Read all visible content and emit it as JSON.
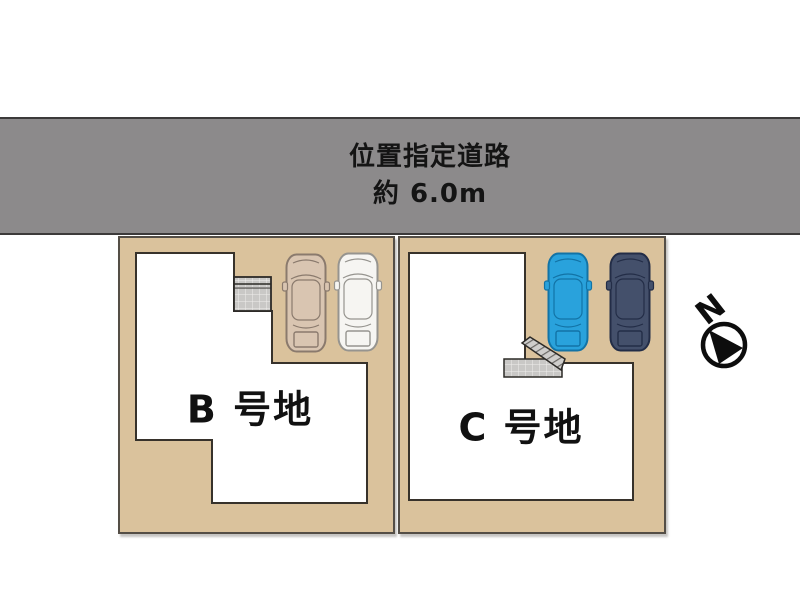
{
  "road": {
    "label_line1": "位置指定道路",
    "label_line2": "約 6.0m",
    "fill": "#8c8a8b",
    "border": "#3c3a3a"
  },
  "site": {
    "ground_color": "#dac29c",
    "lot_border": "#544e46",
    "building_fill": "#ffffff",
    "building_border": "#37322b",
    "tile_color": "#c9c8c6"
  },
  "lots": [
    {
      "id": "B",
      "label": "B 号地",
      "cars": [
        {
          "name": "beige-car",
          "color": "#d9c5b1",
          "outline": "#8a7a6d"
        },
        {
          "name": "white-car",
          "color": "#f6f5f2",
          "outline": "#96948f"
        }
      ]
    },
    {
      "id": "C",
      "label": "C 号地",
      "cars": [
        {
          "name": "blue-car",
          "color": "#29a2dc",
          "outline": "#1273a6"
        },
        {
          "name": "navy-car",
          "color": "#44506b",
          "outline": "#232d47"
        }
      ]
    }
  ],
  "compass": {
    "label": "N",
    "color": "#0d0d0d"
  }
}
